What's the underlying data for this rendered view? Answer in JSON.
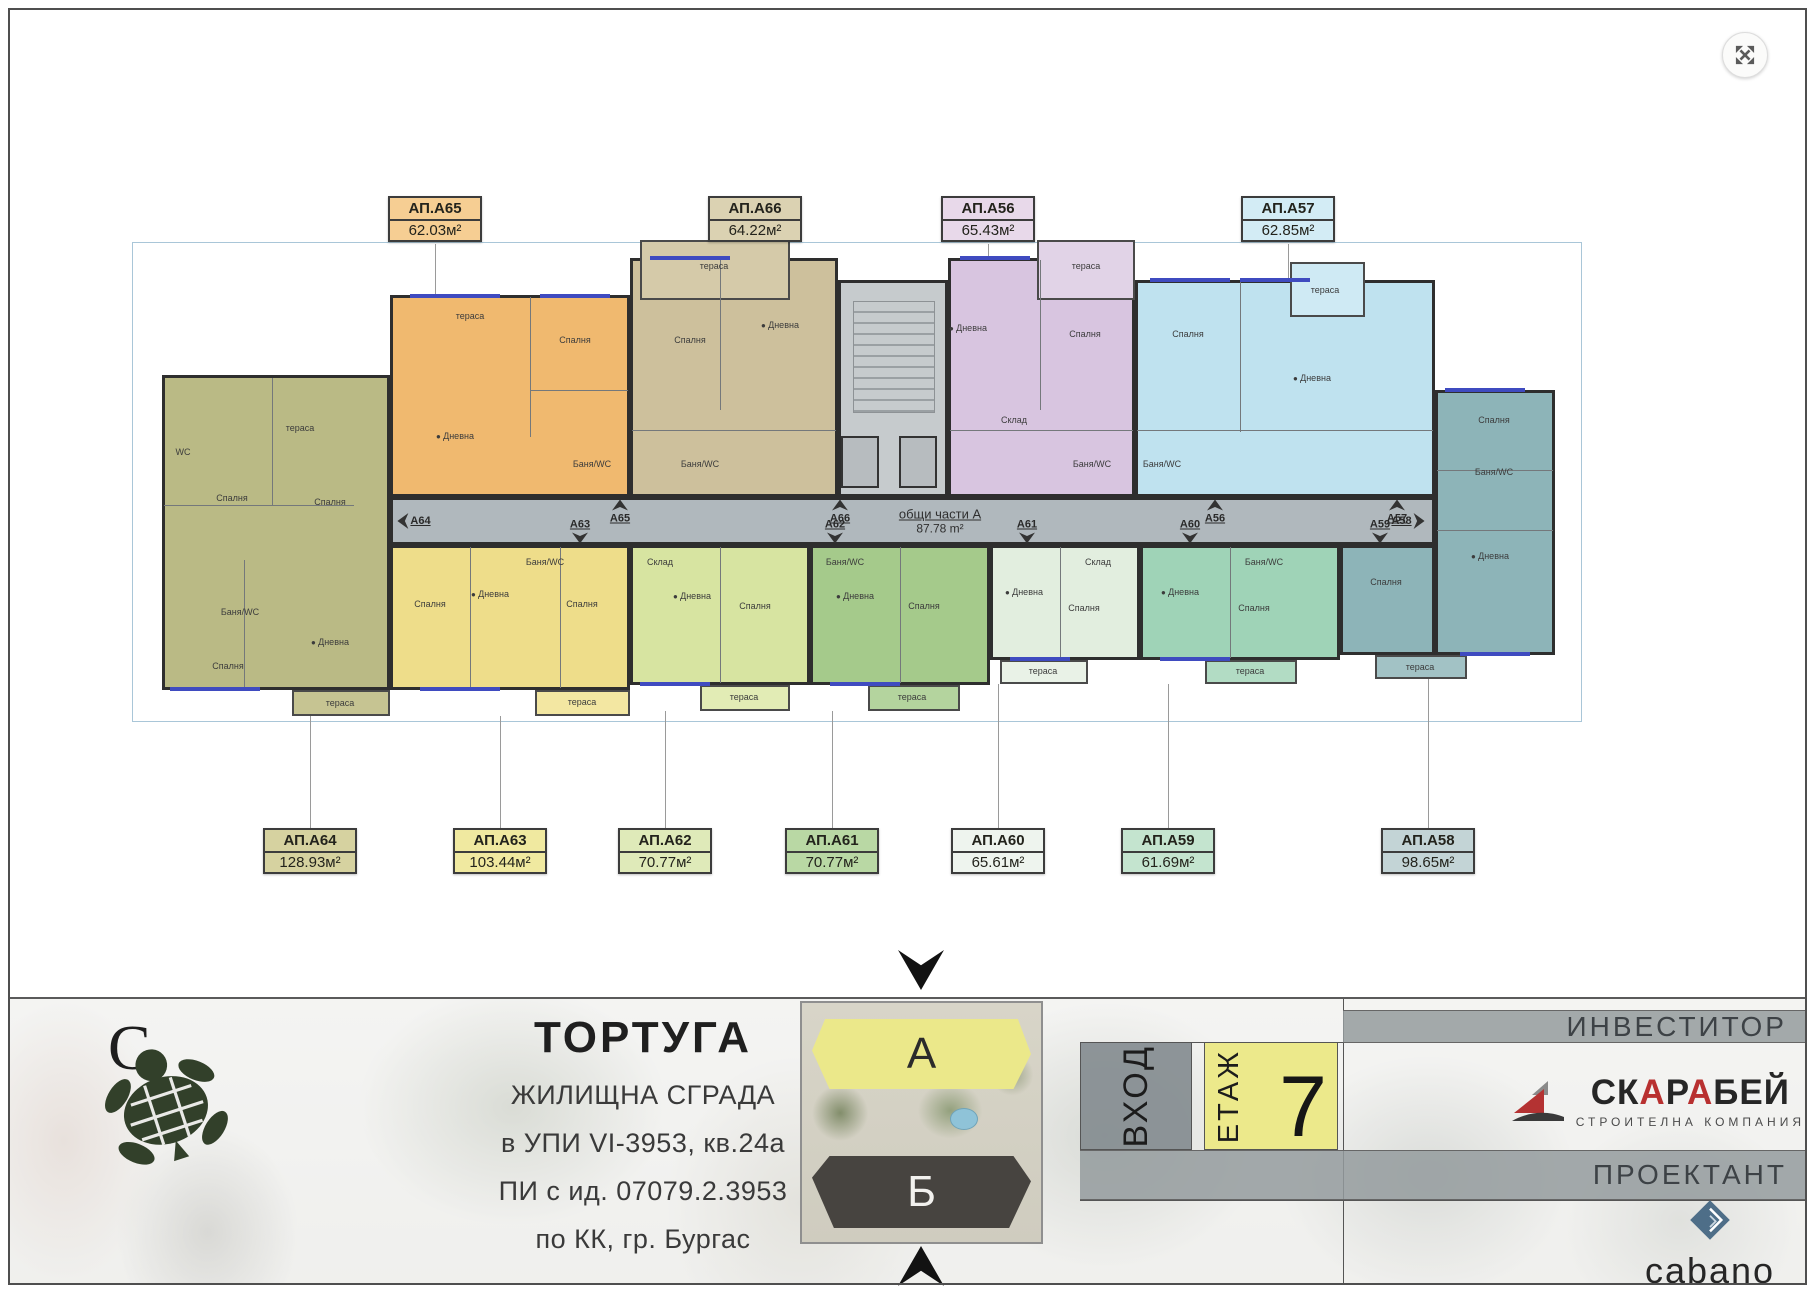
{
  "plan": {
    "common": {
      "label": "общи части А",
      "area": "87.78 m²"
    },
    "units": [
      {
        "x": 162,
        "y": 375,
        "w": 228,
        "h": 315,
        "bg": "#babа85"
      },
      {
        "x": 162,
        "y": 375,
        "w": 228,
        "h": 315,
        "bg": "#baba85"
      },
      {
        "x": 390,
        "y": 295,
        "w": 240,
        "h": 202,
        "bg": "#f0b96f"
      },
      {
        "x": 630,
        "y": 258,
        "w": 208,
        "h": 239,
        "bg": "#cdc09c"
      },
      {
        "x": 948,
        "y": 258,
        "w": 187,
        "h": 239,
        "bg": "#d8c5e0"
      },
      {
        "x": 1135,
        "y": 280,
        "w": 300,
        "h": 217,
        "bg": "#bfe2ef"
      },
      {
        "x": 1435,
        "y": 390,
        "w": 120,
        "h": 265,
        "bg": "#8db4b8"
      },
      {
        "x": 1340,
        "y": 545,
        "w": 95,
        "h": 110,
        "bg": "#8db4b8"
      },
      {
        "x": 390,
        "y": 545,
        "w": 240,
        "h": 145,
        "bg": "#eedd8a"
      },
      {
        "x": 630,
        "y": 545,
        "w": 180,
        "h": 140,
        "bg": "#d7e4a1"
      },
      {
        "x": 810,
        "y": 545,
        "w": 180,
        "h": 140,
        "bg": "#a5ca8b"
      },
      {
        "x": 990,
        "y": 545,
        "w": 150,
        "h": 115,
        "bg": "#e2eedf"
      },
      {
        "x": 1140,
        "y": 545,
        "w": 200,
        "h": 115,
        "bg": "#9fd3b7"
      }
    ],
    "terraces": [
      {
        "x": 640,
        "y": 240,
        "w": 150,
        "h": 60,
        "bg": "#d5caa9"
      },
      {
        "x": 1037,
        "y": 240,
        "w": 98,
        "h": 60,
        "bg": "#e1d3e7"
      },
      {
        "x": 1290,
        "y": 262,
        "w": 75,
        "h": 55,
        "bg": "#cfeaf4"
      },
      {
        "x": 292,
        "y": 690,
        "w": 98,
        "h": 26,
        "bg": "#c6c492"
      },
      {
        "x": 535,
        "y": 690,
        "w": 95,
        "h": 26,
        "bg": "#f3e7a2"
      },
      {
        "x": 700,
        "y": 685,
        "w": 90,
        "h": 26,
        "bg": "#e2ecb5"
      },
      {
        "x": 868,
        "y": 685,
        "w": 92,
        "h": 26,
        "bg": "#b4d49e"
      },
      {
        "x": 1000,
        "y": 660,
        "w": 88,
        "h": 24,
        "bg": "#e9f2e7"
      },
      {
        "x": 1205,
        "y": 660,
        "w": 92,
        "h": 24,
        "bg": "#b2dcc4"
      },
      {
        "x": 1375,
        "y": 655,
        "w": 92,
        "h": 24,
        "bg": "#a2c2c5"
      }
    ],
    "ilines": [
      {
        "x": 272,
        "y": 378,
        "w": 1,
        "h": 127
      },
      {
        "x": 164,
        "y": 505,
        "w": 190,
        "h": 1
      },
      {
        "x": 244,
        "y": 560,
        "w": 1,
        "h": 128
      },
      {
        "x": 530,
        "y": 297,
        "w": 1,
        "h": 140
      },
      {
        "x": 530,
        "y": 390,
        "w": 98,
        "h": 1
      },
      {
        "x": 720,
        "y": 260,
        "w": 1,
        "h": 150
      },
      {
        "x": 632,
        "y": 430,
        "w": 204,
        "h": 1
      },
      {
        "x": 1040,
        "y": 260,
        "w": 1,
        "h": 150
      },
      {
        "x": 950,
        "y": 430,
        "w": 183,
        "h": 1
      },
      {
        "x": 1240,
        "y": 282,
        "w": 1,
        "h": 150
      },
      {
        "x": 1137,
        "y": 430,
        "w": 296,
        "h": 1
      },
      {
        "x": 1437,
        "y": 470,
        "w": 116,
        "h": 1
      },
      {
        "x": 1437,
        "y": 530,
        "w": 116,
        "h": 1
      },
      {
        "x": 470,
        "y": 547,
        "w": 1,
        "h": 141
      },
      {
        "x": 560,
        "y": 547,
        "w": 1,
        "h": 141
      },
      {
        "x": 720,
        "y": 547,
        "w": 1,
        "h": 136
      },
      {
        "x": 900,
        "y": 547,
        "w": 1,
        "h": 136
      },
      {
        "x": 1060,
        "y": 547,
        "w": 1,
        "h": 111
      },
      {
        "x": 1230,
        "y": 547,
        "w": 1,
        "h": 111
      }
    ],
    "windows": [
      {
        "x": 410,
        "y": 294,
        "w": 90
      },
      {
        "x": 540,
        "y": 294,
        "w": 70
      },
      {
        "x": 650,
        "y": 256,
        "w": 80
      },
      {
        "x": 960,
        "y": 256,
        "w": 70
      },
      {
        "x": 1150,
        "y": 278,
        "w": 80
      },
      {
        "x": 1240,
        "y": 278,
        "w": 70
      },
      {
        "x": 1445,
        "y": 388,
        "w": 80
      },
      {
        "x": 420,
        "y": 687,
        "w": 80
      },
      {
        "x": 640,
        "y": 682,
        "w": 70
      },
      {
        "x": 830,
        "y": 682,
        "w": 70
      },
      {
        "x": 1010,
        "y": 657,
        "w": 60
      },
      {
        "x": 1160,
        "y": 657,
        "w": 70
      },
      {
        "x": 1460,
        "y": 652,
        "w": 70
      },
      {
        "x": 170,
        "y": 687,
        "w": 90
      }
    ],
    "rooms": [
      {
        "t": "WC",
        "x": 183,
        "y": 452
      },
      {
        "t": "Спалня",
        "x": 232,
        "y": 498
      },
      {
        "t": "Спалня",
        "x": 330,
        "y": 502
      },
      {
        "t": "тераса",
        "x": 300,
        "y": 428
      },
      {
        "t": "Баня/WC",
        "x": 240,
        "y": 612
      },
      {
        "t": "Дневна",
        "x": 330,
        "y": 642,
        "cls": "dot"
      },
      {
        "t": "Спалня",
        "x": 228,
        "y": 666
      },
      {
        "t": "тераса",
        "x": 340,
        "y": 703
      },
      {
        "t": "тераса",
        "x": 470,
        "y": 316
      },
      {
        "t": "Спалня",
        "x": 575,
        "y": 340
      },
      {
        "t": "Дневна",
        "x": 455,
        "y": 436,
        "cls": "dot"
      },
      {
        "t": "Баня/WC",
        "x": 592,
        "y": 464
      },
      {
        "t": "тераса",
        "x": 714,
        "y": 266
      },
      {
        "t": "Спалня",
        "x": 690,
        "y": 340
      },
      {
        "t": "Дневна",
        "x": 780,
        "y": 325,
        "cls": "dot"
      },
      {
        "t": "Баня/WC",
        "x": 700,
        "y": 464
      },
      {
        "t": "тераса",
        "x": 1086,
        "y": 266
      },
      {
        "t": "Дневна",
        "x": 968,
        "y": 328,
        "cls": "dot"
      },
      {
        "t": "Спалня",
        "x": 1085,
        "y": 334
      },
      {
        "t": "Склад",
        "x": 1014,
        "y": 420
      },
      {
        "t": "Баня/WC",
        "x": 1092,
        "y": 464
      },
      {
        "t": "Спалня",
        "x": 1188,
        "y": 334
      },
      {
        "t": "Дневна",
        "x": 1312,
        "y": 378,
        "cls": "dot"
      },
      {
        "t": "Баня/WC",
        "x": 1162,
        "y": 464
      },
      {
        "t": "тераса",
        "x": 1325,
        "y": 290
      },
      {
        "t": "Спалня",
        "x": 1494,
        "y": 420
      },
      {
        "t": "Баня/WC",
        "x": 1494,
        "y": 472
      },
      {
        "t": "Дневна",
        "x": 1490,
        "y": 556,
        "cls": "dot"
      },
      {
        "t": "Спалня",
        "x": 1386,
        "y": 582
      },
      {
        "t": "тераса",
        "x": 1420,
        "y": 667
      },
      {
        "t": "Баня/WC",
        "x": 545,
        "y": 562
      },
      {
        "t": "Дневна",
        "x": 490,
        "y": 594,
        "cls": "dot"
      },
      {
        "t": "Спалня",
        "x": 430,
        "y": 604
      },
      {
        "t": "Спалня",
        "x": 582,
        "y": 604
      },
      {
        "t": "тераса",
        "x": 582,
        "y": 702
      },
      {
        "t": "Склад",
        "x": 660,
        "y": 562
      },
      {
        "t": "Дневна",
        "x": 692,
        "y": 596,
        "cls": "dot"
      },
      {
        "t": "Спалня",
        "x": 755,
        "y": 606
      },
      {
        "t": "тераса",
        "x": 744,
        "y": 697
      },
      {
        "t": "Баня/WC",
        "x": 845,
        "y": 562
      },
      {
        "t": "Дневна",
        "x": 855,
        "y": 596,
        "cls": "dot"
      },
      {
        "t": "Спалня",
        "x": 924,
        "y": 606
      },
      {
        "t": "тераса",
        "x": 912,
        "y": 697
      },
      {
        "t": "Склад",
        "x": 1098,
        "y": 562
      },
      {
        "t": "Дневна",
        "x": 1024,
        "y": 592,
        "cls": "dot"
      },
      {
        "t": "Спалня",
        "x": 1084,
        "y": 608
      },
      {
        "t": "тераса",
        "x": 1043,
        "y": 671
      },
      {
        "t": "Баня/WC",
        "x": 1264,
        "y": 562
      },
      {
        "t": "Дневна",
        "x": 1180,
        "y": 592,
        "cls": "dot"
      },
      {
        "t": "Спалня",
        "x": 1254,
        "y": 608
      },
      {
        "t": "тераса",
        "x": 1250,
        "y": 671
      }
    ],
    "doors": [
      {
        "t": "А64",
        "x": 414,
        "y": 521,
        "pos": "left"
      },
      {
        "t": "А65",
        "x": 620,
        "y": 512,
        "pos": "top"
      },
      {
        "t": "А66",
        "x": 840,
        "y": 512,
        "pos": "top"
      },
      {
        "t": "А56",
        "x": 1215,
        "y": 512,
        "pos": "top"
      },
      {
        "t": "А57",
        "x": 1397,
        "y": 512,
        "pos": "top"
      },
      {
        "t": "А63",
        "x": 580,
        "y": 531,
        "pos": "bottom"
      },
      {
        "t": "А62",
        "x": 835,
        "y": 531,
        "pos": "bottom"
      },
      {
        "t": "А61",
        "x": 1027,
        "y": 531,
        "pos": "bottom"
      },
      {
        "t": "А60",
        "x": 1190,
        "y": 531,
        "pos": "bottom"
      },
      {
        "t": "А59",
        "x": 1380,
        "y": 531,
        "pos": "bottom"
      },
      {
        "t": "А58",
        "x": 1408,
        "y": 521,
        "pos": "right"
      }
    ],
    "badges_top": [
      {
        "name": "АП.А65",
        "area": "62.03м²",
        "bg": "#f6ce93",
        "x": 435,
        "y": 196
      },
      {
        "name": "АП.А66",
        "area": "64.22м²",
        "bg": "#dbd2b2",
        "x": 755,
        "y": 196
      },
      {
        "name": "АП.А56",
        "area": "65.43м²",
        "bg": "#e8d9ea",
        "x": 988,
        "y": 196
      },
      {
        "name": "АП.А57",
        "area": "62.85м²",
        "bg": "#d3ecf5",
        "x": 1288,
        "y": 196
      }
    ],
    "badges_bottom": [
      {
        "name": "АП.А64",
        "area": "128.93м²",
        "bg": "#d6d2a0",
        "x": 310,
        "y": 828
      },
      {
        "name": "АП.А63",
        "area": "103.44м²",
        "bg": "#f0e9a0",
        "x": 500,
        "y": 828
      },
      {
        "name": "АП.А62",
        "area": "70.77м²",
        "bg": "#dfeab9",
        "x": 665,
        "y": 828
      },
      {
        "name": "АП.А61",
        "area": "70.77м²",
        "bg": "#b9d8a4",
        "x": 832,
        "y": 828
      },
      {
        "name": "АП.А60",
        "area": "65.61м²",
        "bg": "#eef4ee",
        "x": 998,
        "y": 828
      },
      {
        "name": "АП.А59",
        "area": "61.69м²",
        "bg": "#c4e4cf",
        "x": 1168,
        "y": 828
      },
      {
        "name": "АП.А58",
        "area": "98.65м²",
        "bg": "#c3d4d6",
        "x": 1428,
        "y": 828
      }
    ],
    "leaders": [
      {
        "x": 435,
        "y": 244,
        "h": 51
      },
      {
        "x": 755,
        "y": 244,
        "h": 14
      },
      {
        "x": 988,
        "y": 244,
        "h": 14
      },
      {
        "x": 1288,
        "y": 244,
        "h": 36
      },
      {
        "x": 310,
        "y": 716,
        "h": 112
      },
      {
        "x": 500,
        "y": 716,
        "h": 112
      },
      {
        "x": 665,
        "y": 711,
        "h": 117
      },
      {
        "x": 832,
        "y": 711,
        "h": 117
      },
      {
        "x": 998,
        "y": 684,
        "h": 144
      },
      {
        "x": 1168,
        "y": 684,
        "h": 144
      },
      {
        "x": 1428,
        "y": 679,
        "h": 149
      }
    ]
  },
  "footer": {
    "north": "С",
    "title": "ТОРТУГА",
    "lines": [
      "ЖИЛИЩНА СГРАДА",
      "в УПИ VI-3953, кв.24а",
      "ПИ с ид. 07079.2.3953",
      "по КК, гр. Бургас"
    ],
    "map": {
      "building_a": "А",
      "building_b": "Б"
    },
    "entrance_label": "ВХОД",
    "floor_label": "ЕТАЖ",
    "floor_number": "7",
    "investor_label": "ИНВЕСТИТОР",
    "investor": {
      "p1": "СК",
      "a1": "А",
      "p2": "Р",
      "a2": "А",
      "p3": "БЕЙ",
      "sub": "СТРОИТЕЛНА КОМПАНИЯ"
    },
    "designer_label": "ПРОЕКТАНТ",
    "designer_name": "cabano"
  }
}
